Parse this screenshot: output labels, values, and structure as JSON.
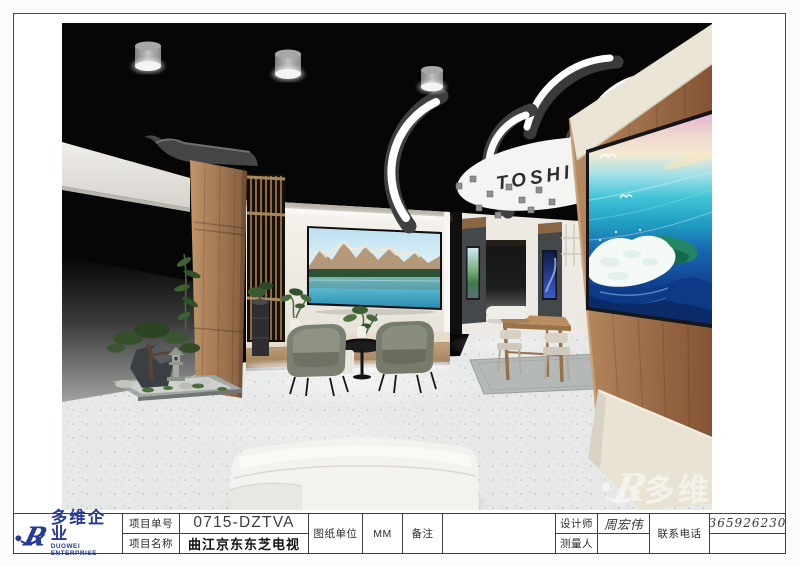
{
  "render": {
    "brand_text": "TOSHIBA",
    "watermark_text": "多维",
    "watermark_mark": "R",
    "description": "3D perspective render of a Toshiba TV showroom booth",
    "colors": {
      "ceiling": "#060606",
      "wood": "#a87952",
      "wall": "#f1eee8",
      "floor": "#e7e9e8",
      "accent_blue": "#24399a"
    }
  },
  "title_block": {
    "logo": {
      "mark": "R",
      "cn": "多维企业",
      "en": "DUOWEI ENTERPRISE",
      "color": "#24399a"
    },
    "fields": {
      "project_no_label": "项目单号",
      "project_no": "0715-DZTVA",
      "project_name_label": "项目名称",
      "project_name": "曲江京东东芝电视",
      "unit_label": "图纸单位",
      "unit": "MM",
      "remark_label": "备注",
      "remark": "",
      "designer_label": "设计师",
      "designer": "周宏伟",
      "surveyor_label": "测量人",
      "surveyor": "",
      "phone_label": "联系电话",
      "phone": "13659262305"
    }
  }
}
